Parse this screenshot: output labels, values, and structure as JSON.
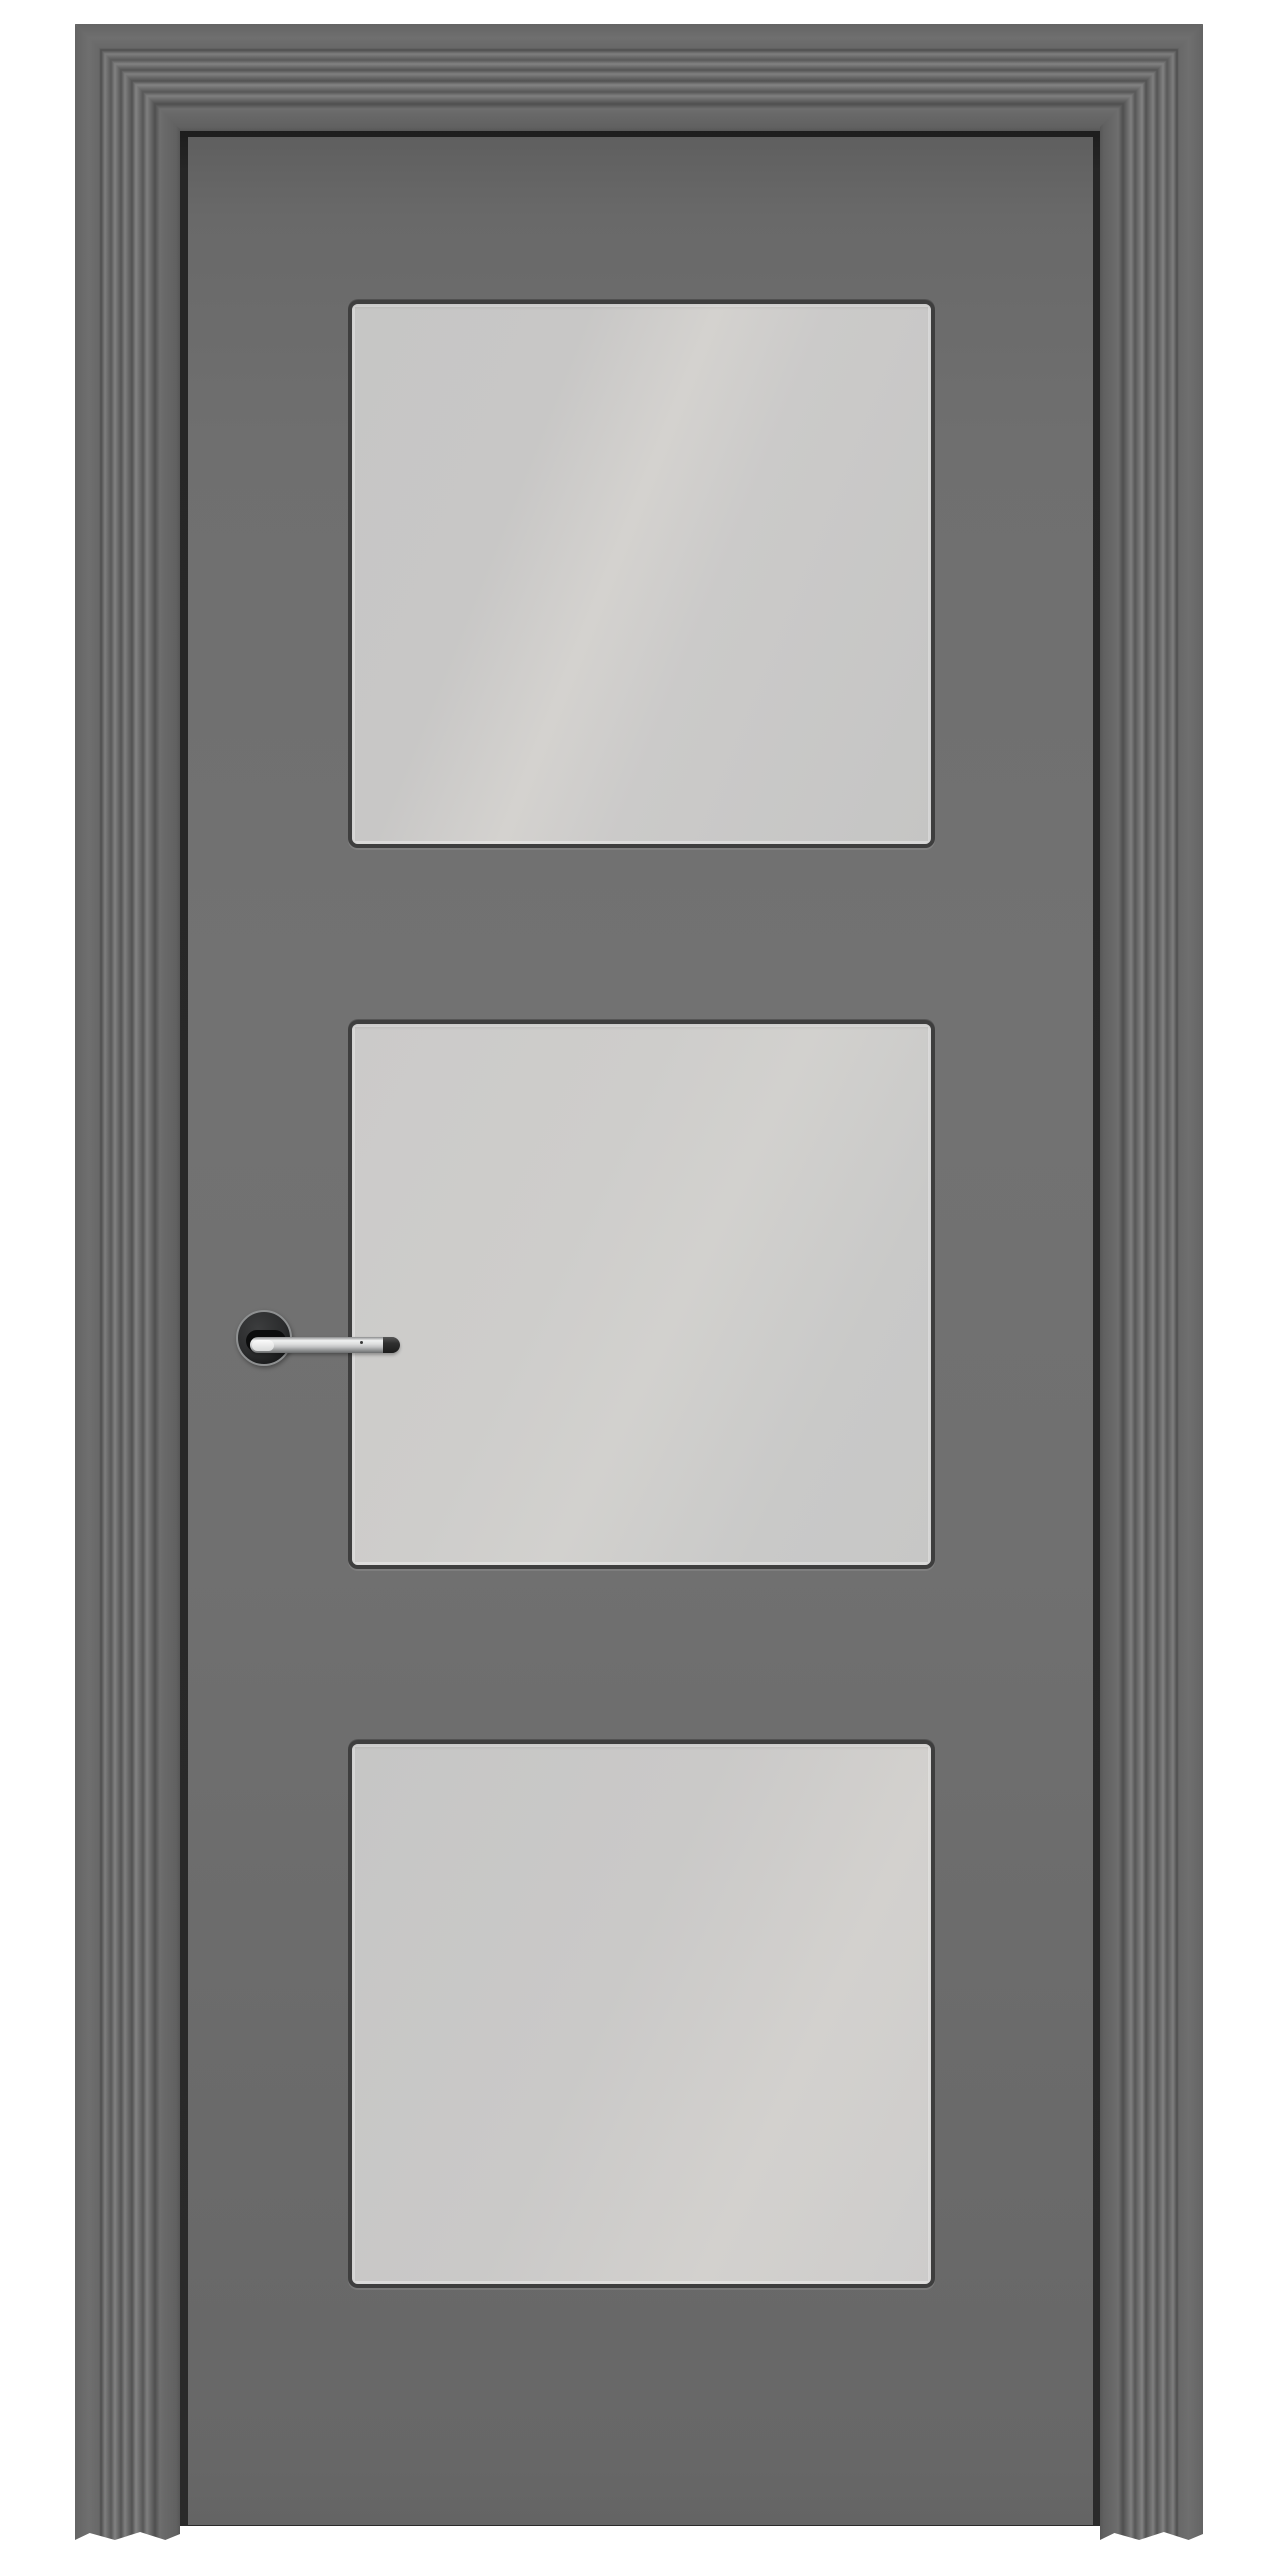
{
  "scene": {
    "type": "product-photo",
    "subject": "gray interior door with three frosted glass panels and chrome lever handle, shown closed inside a stepped architrave casing on a white background",
    "door": {
      "panel_count": 3,
      "panel_style": "rectangular frosted glass with dark glazing frame and rounded corners",
      "handle_side": "left",
      "handle_type": "chrome lever on round dark rosette",
      "casing_style": "stepped ribbed architrave, mitered corners, scalloped bottom"
    }
  },
  "colors": {
    "background": "#ffffff",
    "casing_base": "#646464",
    "casing_rib_dark": "#4e4e4e",
    "casing_rib_light": "#828282",
    "reveal_shadow": "#242424",
    "door_leaf": "#6f6f6f",
    "panel_frame": "#3e3e3e",
    "glass": "#cbcac9",
    "glass_sheen": "#d4d2cf",
    "handle_chrome": "#dcdddd",
    "handle_tip": "#2b2b2b",
    "rosette": "#2b2c2d",
    "rosette_rim": "#8e9091"
  }
}
